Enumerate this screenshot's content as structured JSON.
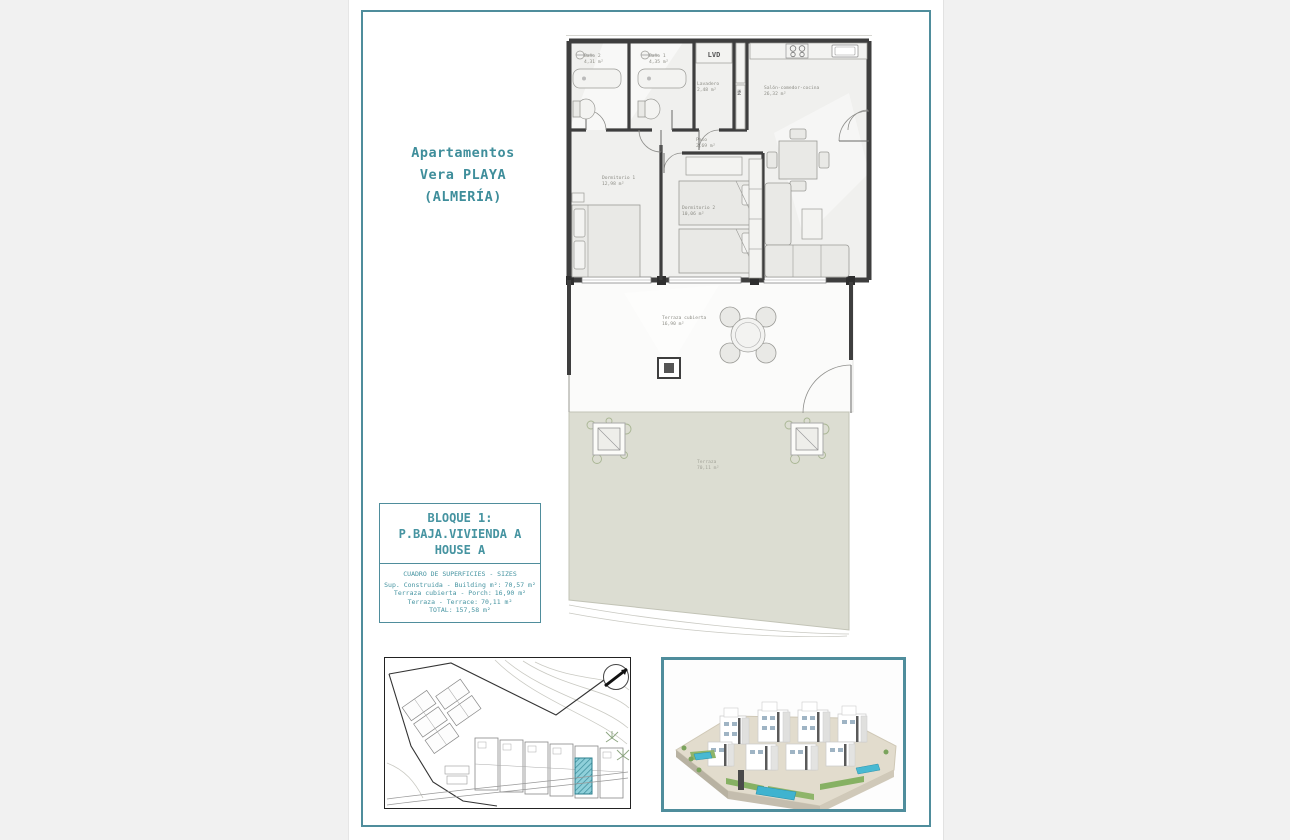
{
  "header": {
    "title_lines": [
      "Apartamentos",
      "Vera PLAYA",
      "(ALMERÍA)"
    ]
  },
  "info_box": {
    "block_lines": [
      "BLOQUE 1:",
      "P.BAJA.VIVIENDA A",
      "HOUSE A"
    ],
    "surfaces_title": "CUADRO DE SUPERFICIES - SIZES",
    "rows": [
      {
        "label": "Sup. Construida - Building m²:",
        "value": "70,57 m²"
      },
      {
        "label": "Terraza cubierta - Porch:",
        "value": "16,90 m²"
      },
      {
        "label": "Terraza - Terrace:",
        "value": "70,11 m²"
      },
      {
        "label": "TOTAL:",
        "value": "157,58 m²"
      }
    ]
  },
  "plan": {
    "rooms": [
      {
        "name": "Baño 2",
        "area": "4,31 m²"
      },
      {
        "name": "Baño 1",
        "area": "4,35 m²"
      },
      {
        "name": "Lavadero",
        "area": "2,48 m²"
      },
      {
        "name": "Salón-comedor-cocina",
        "area": "26,32 m²"
      },
      {
        "name": "Paso",
        "area": "2,69 m²"
      },
      {
        "name": "Dormitorio 1",
        "area": "12,98 m²"
      },
      {
        "name": "Dormitorio 2",
        "area": "10,06 m²"
      },
      {
        "name": "Terraza cubierta",
        "area": "16,90 m²"
      },
      {
        "name": "Terraza",
        "area": "70,11 m²"
      }
    ],
    "labels": {
      "lvd": "LVD",
      "mh": "MH"
    }
  },
  "colors": {
    "accent_teal": "#4f8d9c",
    "title_teal": "#3f8e9b",
    "wall": "#3e3e3e",
    "garden": "#dcddd2",
    "highlight_unit": "#5cb6c6",
    "pool_blue": "#3fb3cf"
  }
}
